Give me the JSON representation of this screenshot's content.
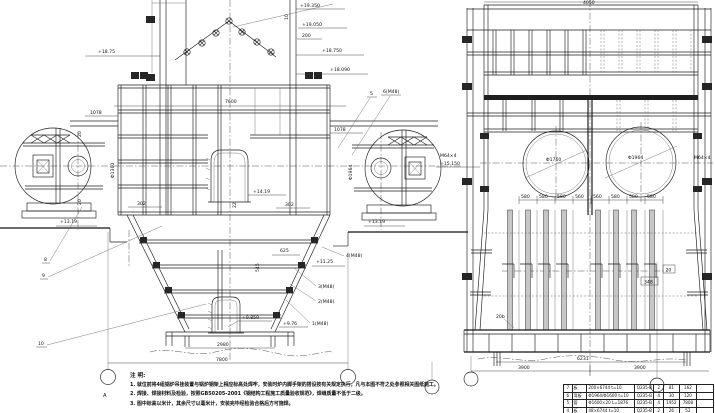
{
  "lv": {
    "e19350": "+19.350",
    "e19050": "+19.050",
    "e18750r": "+18.750",
    "e18090": "+18.090",
    "e1875l": "+18.75",
    "d10": "10",
    "d200": "200",
    "d7600": "7600",
    "d1078l": "1078",
    "d1078r": "1078",
    "d20t": "20",
    "d20b": "20",
    "d302l": "302",
    "d302r": "302",
    "phi1360": "Φ1360",
    "phi1964": "Φ1964",
    "e1419": "+14.19",
    "d22": "22",
    "e1319l": "+13.19",
    "e1319r": "+13.19",
    "c5": "5",
    "c6": "6(M48)",
    "c8": "8",
    "c9": "9",
    "c10": "10",
    "e1125": "+11.25",
    "d625": "625",
    "d545": "545",
    "c4": "4(M48)",
    "c3": "3(M48)",
    "c2": "2(M48)",
    "c1": "1(M48)",
    "e9859": "+9.859",
    "e976": "+9.76",
    "d2980": "2980",
    "d7800": "7800",
    "axisA": "A"
  },
  "rv": {
    "dtop": "4050",
    "phi1760": "Φ1760",
    "phi1964": "Φ1964",
    "boltl": "M64×4",
    "elevl": "+15.150",
    "boltr": "M64×4",
    "chain": [
      "580",
      "580",
      "580",
      "560",
      "560",
      "580",
      "580",
      "580"
    ],
    "d348": "348",
    "d20": "20",
    "c20b": "20b",
    "d6231": "6231",
    "d3900l": "3900",
    "d3900r": "3900"
  },
  "notes": {
    "title": "注  明:",
    "n1": "1. 就位前将4组锅炉吊挂装置与锅炉钢架上相应标高处焊牢，安装时炉内脚手架的搭设按有关规定执行，凡与本图不符之处参照相关图纸施工。",
    "n2": "2. 焊接、焊接材料及检验，按照GB50205-2001《钢结构工程施工质量验收规范》，焊缝质量不低于二级。",
    "n3": "3. 图中标高以米计，其余尺寸以毫米计，安装完毕经检验合格后方可施焊。"
  },
  "bom": {
    "rows": [
      {
        "no": "7",
        "name": "板",
        "spec": "200×6744  t=10",
        "mat": "Q235-B",
        "qty": "2",
        "unit": "81",
        "total": "162",
        "note": ""
      },
      {
        "no": "6",
        "name": "弯板",
        "spec": "Φ1964/Φ1600  t=10",
        "mat": "Q235-B",
        "qty": "4",
        "unit": "30",
        "total": "120",
        "note": ""
      },
      {
        "no": "5",
        "name": "管",
        "spec": "Φ1600×20  L=1876",
        "mat": "Q235-B",
        "qty": "4",
        "unit": "1952",
        "total": "7808",
        "note": ""
      },
      {
        "no": "4",
        "name": "板",
        "spec": "48×6744  t=10",
        "mat": "Q235-B",
        "qty": "2",
        "unit": "26",
        "total": "52",
        "note": ""
      }
    ]
  }
}
